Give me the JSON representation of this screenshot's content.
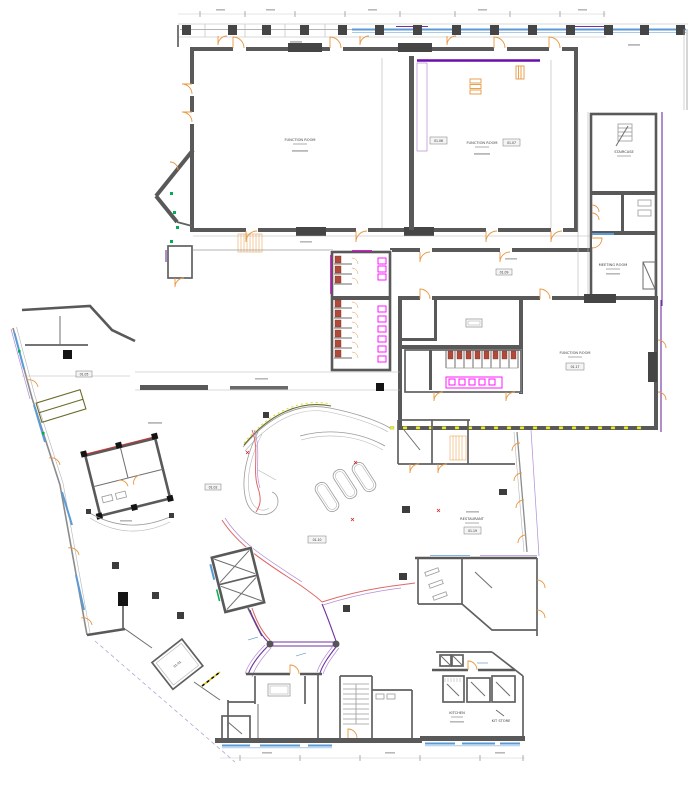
{
  "document": {
    "type": "architectural-floor-plan",
    "view": "ground-floor-plan",
    "background": "#ffffff"
  },
  "colors": {
    "wall": "#595959",
    "glazing_blue": "#5b9bd5",
    "accent_purple": "#7030a0",
    "accent_light_purple": "#b18cd6",
    "fixture_magenta": "#ff00ff",
    "door_orange": "#e8963f",
    "wc_seat_red": "#b04a3a",
    "marker_green": "#00b050",
    "feature_olive": "#6b6b2a",
    "lighting_yellow": "#f2f200",
    "curve_pink": "#e06666"
  },
  "labels": {
    "function_room_a": {
      "name": "FUNCTION ROOM",
      "tag": "01.06"
    },
    "function_room_b": {
      "name": "FUNCTION ROOM",
      "tag": "01.07"
    },
    "function_room_c": {
      "name": "FUNCTION ROOM",
      "tag": "01.17"
    },
    "meeting_room": {
      "name": "MEETING ROOM",
      "tag": "01.12"
    },
    "staircase": {
      "name": "STAIRCASE"
    },
    "restaurant": {
      "name": "RESTAURANT",
      "tag": "01.19"
    },
    "kitchen": {
      "name": "KITCHEN",
      "tag": "01.21"
    },
    "kitchen_store": {
      "name": "KIT STORE",
      "tag": "01.22"
    },
    "lobby_tag": "01.10",
    "hall_tag": "01.02",
    "upper_hall_tag": "01.09",
    "store_tag": "01.05",
    "vestibule_tag": "01.01"
  }
}
